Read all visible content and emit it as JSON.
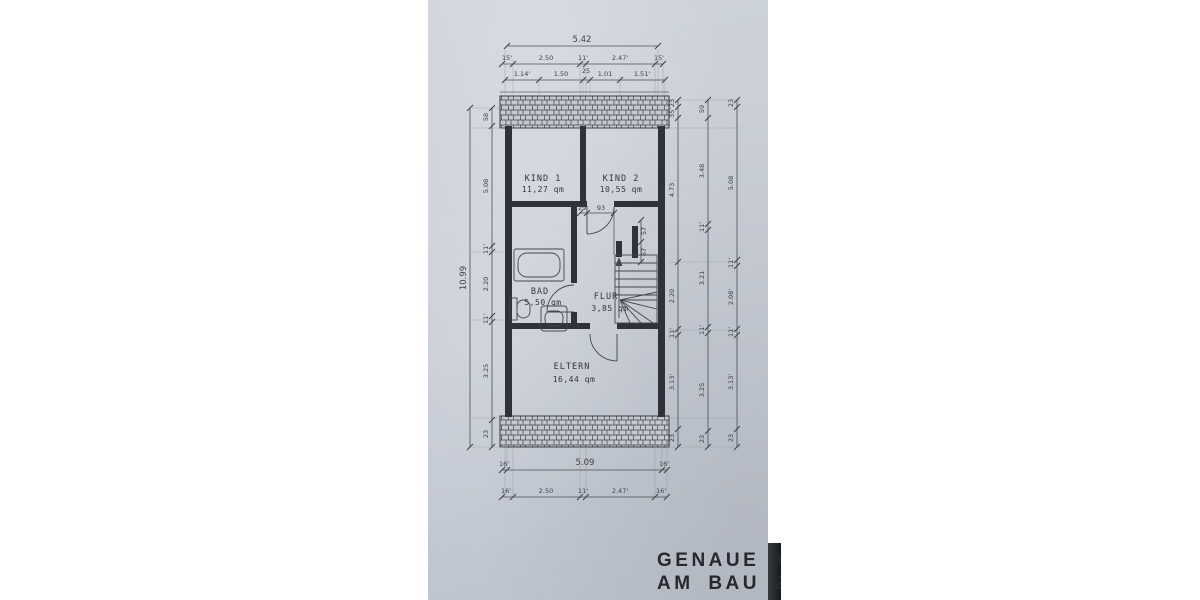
{
  "note": {
    "line1": "GENAUE MAS",
    "line2": "AM BAU ZU N"
  },
  "rooms": {
    "kind1": {
      "name": "KIND 1",
      "area": "11,27 qm"
    },
    "kind2": {
      "name": "KIND 2",
      "area": "10,55 qm"
    },
    "bad": {
      "name": "BAD",
      "area": "5,50 qm"
    },
    "flur": {
      "name": "FLUR",
      "area": "3,85 qm"
    },
    "eltern": {
      "name": "ELTERN",
      "area": "16,44 qm"
    }
  },
  "dims": {
    "top": {
      "total": "5.42",
      "row2": [
        "15'",
        "2.50",
        "11'",
        "2.47'",
        "15'"
      ],
      "row3": [
        "1.14'",
        "1.50",
        "25",
        "1.01",
        "1.51'"
      ]
    },
    "bottom": {
      "row1": [
        "16'",
        "5.09",
        "16'"
      ],
      "row2": [
        "16'",
        "2.50",
        "11'",
        "2.47'",
        "16'"
      ]
    },
    "left": {
      "outer_total": "10.99",
      "inner": [
        "58",
        "5.08",
        "11'",
        "2.20",
        "11'",
        "3.25",
        "23"
      ]
    },
    "right": {
      "inner": [
        "23",
        "35'",
        "4.73",
        "2.20",
        "11'",
        "3.13'",
        "23"
      ],
      "middle": [
        "59",
        "3.48",
        "11'",
        "3.21",
        "11'",
        "3.25",
        "23"
      ],
      "outer": [
        "23",
        "5.08",
        "11'",
        "2.08'",
        "11'",
        "3.13'",
        "23"
      ]
    },
    "interior": {
      "h1": "29'",
      "h2": "93",
      "v1": "57",
      "v2": "67"
    }
  },
  "colors": {
    "paper": "#c7ccd5",
    "ink": "#2f3339",
    "dim_line": "#4a4e55",
    "note_text": "#26282d",
    "photo_edge_dark": "#17181b",
    "page_bg": "#ffffff"
  }
}
